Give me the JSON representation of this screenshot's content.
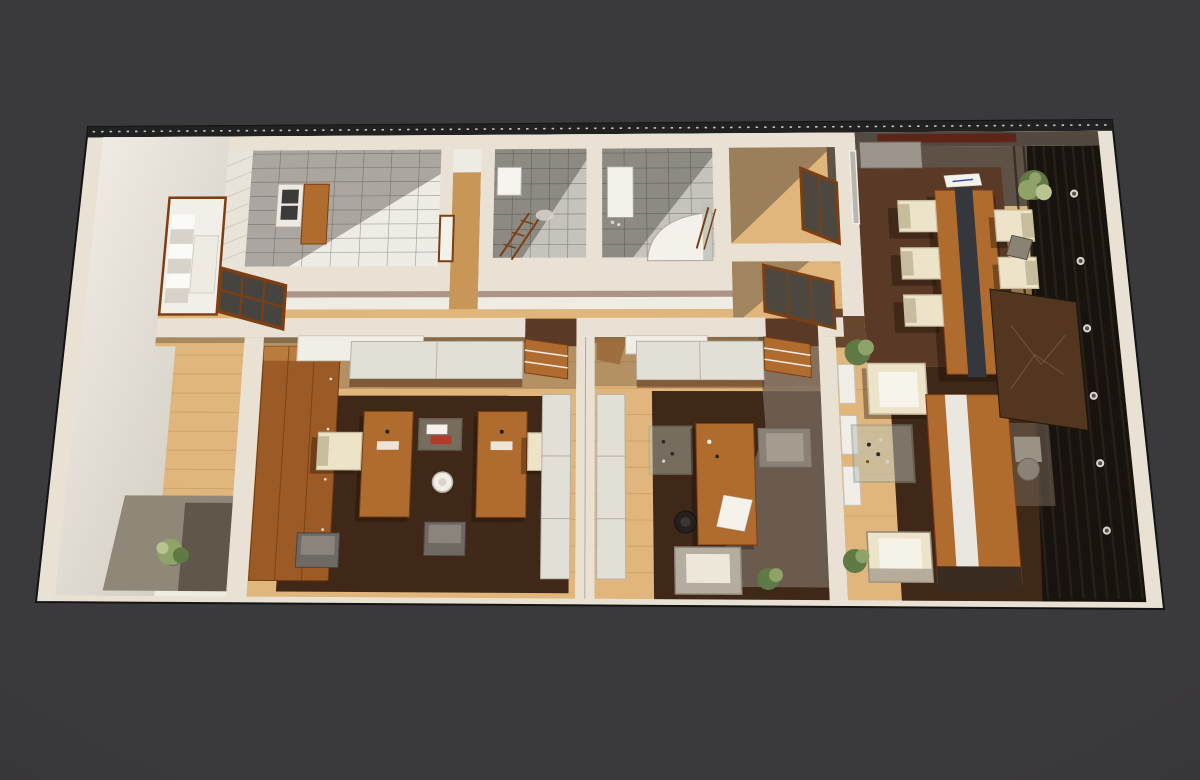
{
  "scene": {
    "type": "3d-floor-plan-render",
    "view": "top-down-perspective",
    "rooms": [
      {
        "id": "entry-hall",
        "contents": [
          "white wall face",
          "staircase in wood-framed nook",
          "wood floor strip"
        ]
      },
      {
        "id": "kitchen",
        "contents": [
          "white tile floor",
          "cooktop counter",
          "wood cabinet",
          "hatched tile wall"
        ]
      },
      {
        "id": "bathroom-1",
        "contents": [
          "gray tile floor",
          "wall niche",
          "wood towel ladder",
          "oval mat"
        ]
      },
      {
        "id": "bathroom-2",
        "contents": [
          "gray tile floor",
          "vanity sink",
          "curved shower stall",
          "glass partition",
          "towel ladder"
        ]
      },
      {
        "id": "small-room-upper",
        "contents": [
          "wood floor",
          "wood framed window"
        ]
      },
      {
        "id": "small-room-lower",
        "contents": [
          "wood floor",
          "wood framed window"
        ]
      },
      {
        "id": "hallway",
        "contents": [
          "wood plank floor",
          "interior window",
          "door thresholds"
        ]
      },
      {
        "id": "west-corridor",
        "contents": [
          "wood floor",
          "concrete patch",
          "potted plant"
        ]
      },
      {
        "id": "office-1",
        "contents": [
          "wood wardrobe",
          "white sideboard",
          "wood shelf unit",
          "two wood desks",
          "two cream chairs",
          "white office chair",
          "magazine table",
          "two cube seats",
          "dark rug",
          "tall white cabinet"
        ]
      },
      {
        "id": "office-2",
        "contents": [
          "tall white cabinet",
          "white sideboard",
          "wood shelf unit",
          "wood desk with papers",
          "black office chair",
          "gray guest chair",
          "glass side table",
          "armchair",
          "plant",
          "dark rug"
        ]
      },
      {
        "id": "dining-area",
        "contents": [
          "gray-brown floor",
          "dark mat",
          "long wood table with dark runner",
          "newspaper",
          "six cream chairs",
          "credenza",
          "plant",
          "basket"
        ]
      },
      {
        "id": "lounge-office",
        "contents": [
          "wall shelf boxes",
          "two cream armchairs",
          "glass coffee table with bottles",
          "executive desk with white stripe",
          "gray desk chair",
          "art panel",
          "dark slat accent wall",
          "six round sconces",
          "plants"
        ]
      }
    ]
  },
  "palette": {
    "background": "#3a393c",
    "background_edge": "#2b2a2d",
    "frame_outline": "#141414",
    "wall_cream": "#e9e2d4",
    "wall_bright": "#f4f1ea",
    "wall_shadow": "#ccc6ba",
    "wall_dark_top": "#222122",
    "hatch_tick": "#d9d4c6",
    "interior_base": "#efece4",
    "wood_floor_light": "#e0b67c",
    "wood_floor_mid": "#c89758",
    "wood_plank_line": "#a87c44",
    "rug_dark_brown": "#3f2817",
    "rug_brown": "#5a3a26",
    "floor_gray_brown": "#5e5146",
    "concrete": "#8f8778",
    "tile_white": "#efece5",
    "tile_gray": "#c6c3bc",
    "tile_line": "#514e49",
    "furniture_wood": "#b06c2e",
    "furniture_wood_dark": "#7c3f14",
    "table_runner": "#34383d",
    "chair_cream": "#ece3c8",
    "chair_cream_shadow": "#c7bc9d",
    "chair_gray": "#8b8177",
    "chair_black": "#23201e",
    "cabinet_white": "#e2dfd6",
    "wardrobe_wood": "#9c5a26",
    "wardrobe_wood_light": "#b97c3e",
    "accent_wall_dark": "#17130e",
    "accent_wall_streak": "#2c261e",
    "art_panel": "#523620",
    "art_lines": "#8a6a42",
    "plant_green": "#8fa368",
    "plant_green_dark": "#5f7a44",
    "plant_green_light": "#b9c492",
    "glass": "#b9c2b8",
    "paper_white": "#f4f2ea",
    "window_glass_dark": "#4c4840",
    "sconce_ring": "#d8d5cd",
    "sconce_core": "#554f48",
    "blind_red": "#5f1f12",
    "dining_top_band": "#4a4038",
    "office_shadow_wall": "#77685c"
  }
}
